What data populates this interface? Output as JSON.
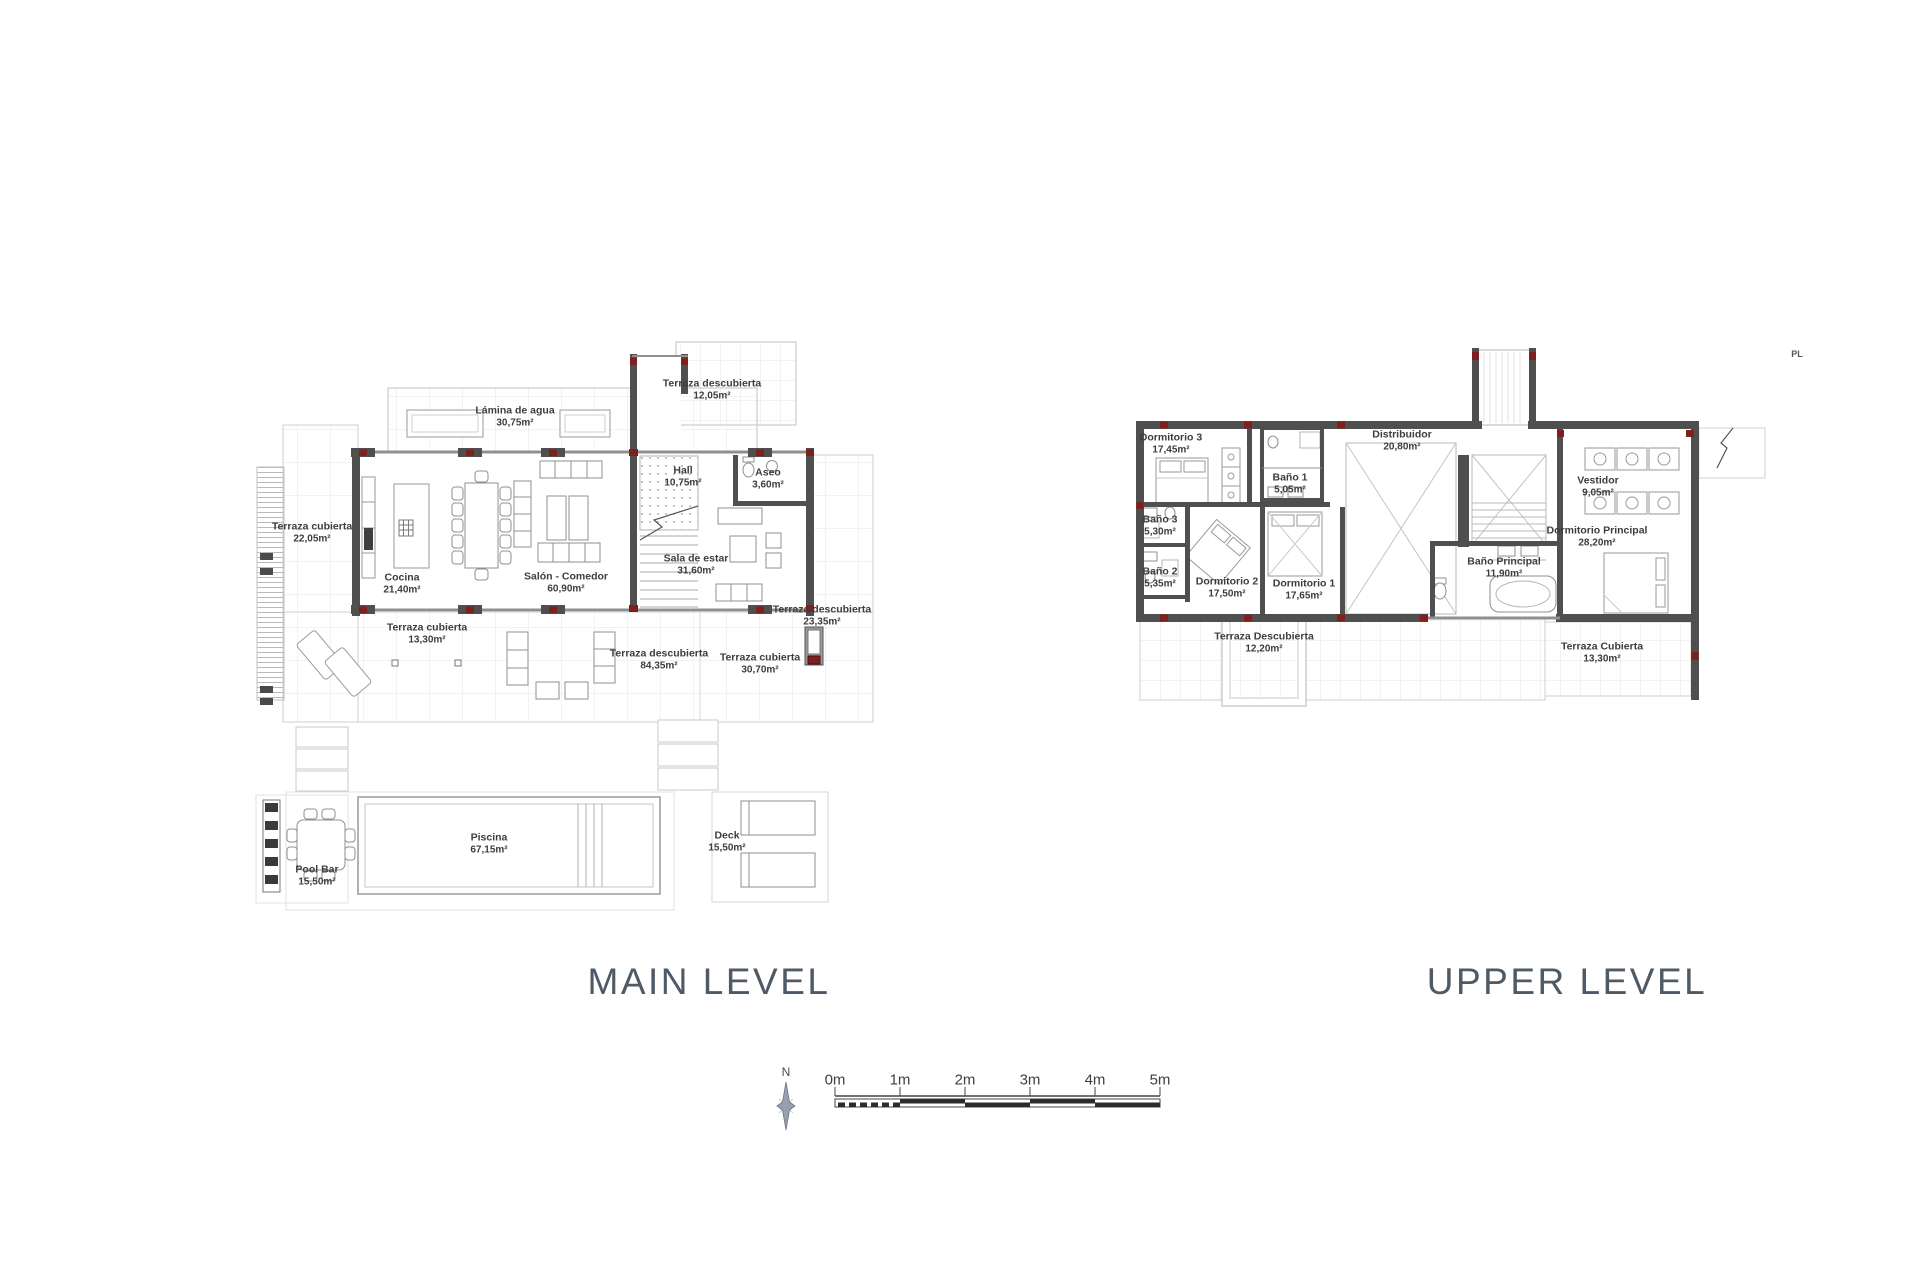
{
  "titles": {
    "main": "MAIN LEVEL",
    "upper": "UPPER LEVEL"
  },
  "corner_mark": "PL",
  "compass": {
    "north_label": "N"
  },
  "scale_bar": {
    "labels": [
      "0m",
      "1m",
      "2m",
      "3m",
      "4m",
      "5m"
    ]
  },
  "colors": {
    "wall": "#4f4f4f",
    "column_accent": "#7e2020",
    "text": "#3d3d3d",
    "title": "#4e5a66",
    "grid": "#e6e6e6"
  },
  "main_level": {
    "rooms": [
      {
        "label": "Terraza cubierta",
        "area": "22,05m²"
      },
      {
        "label": "Lámina de agua",
        "area": "30,75m²"
      },
      {
        "label": "Cocina",
        "area": "21,40m²"
      },
      {
        "label": "Salón - Comedor",
        "area": "60,90m²"
      },
      {
        "label": "Hall",
        "area": "10,75m²"
      },
      {
        "label": "Terraza descubierta",
        "area": "12,05m²"
      },
      {
        "label": "Aseo",
        "area": "3,60m²"
      },
      {
        "label": "Sala de estar",
        "area": "31,60m²"
      },
      {
        "label": "Terraza cubierta",
        "area": "13,30m²"
      },
      {
        "label": "Terraza descubierta",
        "area": "84,35m²"
      },
      {
        "label": "Terraza cubierta",
        "area": "30,70m²"
      },
      {
        "label": "Terraza descubierta",
        "area": "23,35m²"
      },
      {
        "label": "Piscina",
        "area": "67,15m²"
      },
      {
        "label": "Deck",
        "area": "15,50m²"
      },
      {
        "label": "Pool Bar",
        "area": "15,50m²"
      }
    ]
  },
  "upper_level": {
    "rooms": [
      {
        "label": "Dormitorio 3",
        "area": "17,45m²"
      },
      {
        "label": "Distribuidor",
        "area": "20,80m²"
      },
      {
        "label": "Baño 1",
        "area": "5,05m²"
      },
      {
        "label": "Baño 3",
        "area": "5,30m²"
      },
      {
        "label": "Baño 2",
        "area": "5,35m²"
      },
      {
        "label": "Dormitorio 2",
        "area": "17,50m²"
      },
      {
        "label": "Dormitorio 1",
        "area": "17,65m²"
      },
      {
        "label": "Vestidor",
        "area": "9,05m²"
      },
      {
        "label": "Dormitorio Principal",
        "area": "28,20m²"
      },
      {
        "label": "Baño Principal",
        "area": "11,90m²"
      },
      {
        "label": "Terraza Descubierta",
        "area": "12,20m²"
      },
      {
        "label": "Terraza Cubierta",
        "area": "13,30m²"
      }
    ]
  }
}
